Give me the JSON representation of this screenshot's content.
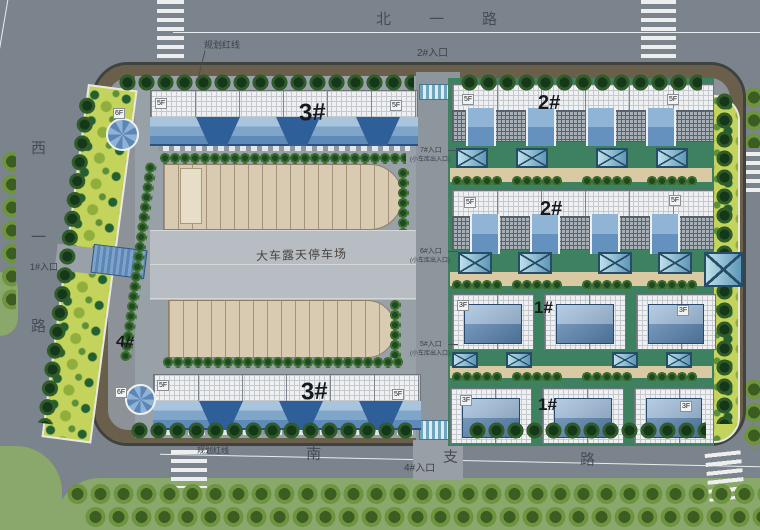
{
  "plan": {
    "roads": {
      "north": "北一路",
      "west": "西一路",
      "south": "南支路"
    },
    "red_line": {
      "top": "规划红线",
      "bottom": "规划红线"
    },
    "entrances": {
      "e1": "1#入口",
      "e2": "2#入口",
      "e4": "4#入口",
      "e5": "5#入口",
      "e6": "6#入口",
      "e7": "7#入口",
      "garage_note": "(小车库出入口)"
    },
    "parking": {
      "label": "大车露天停车场"
    },
    "buildings": {
      "b3_top": "3#",
      "b3_bottom": "3#",
      "b2_row1": "2#",
      "b2_row2": "2#",
      "b1_row3": "1#",
      "b1_row4": "1#",
      "b4": "4#"
    },
    "floors": {
      "f6": "6F",
      "f5": "5F",
      "f3": "3F"
    },
    "colors": {
      "road": "#7b848c",
      "lawn": "#8aa76c",
      "planting": "#c3d35b",
      "courtyard": "#3d8161",
      "roof_blue": "#6f9ac2",
      "parking_tan": "#d9cbb1",
      "tree": "#2f5c28"
    }
  }
}
